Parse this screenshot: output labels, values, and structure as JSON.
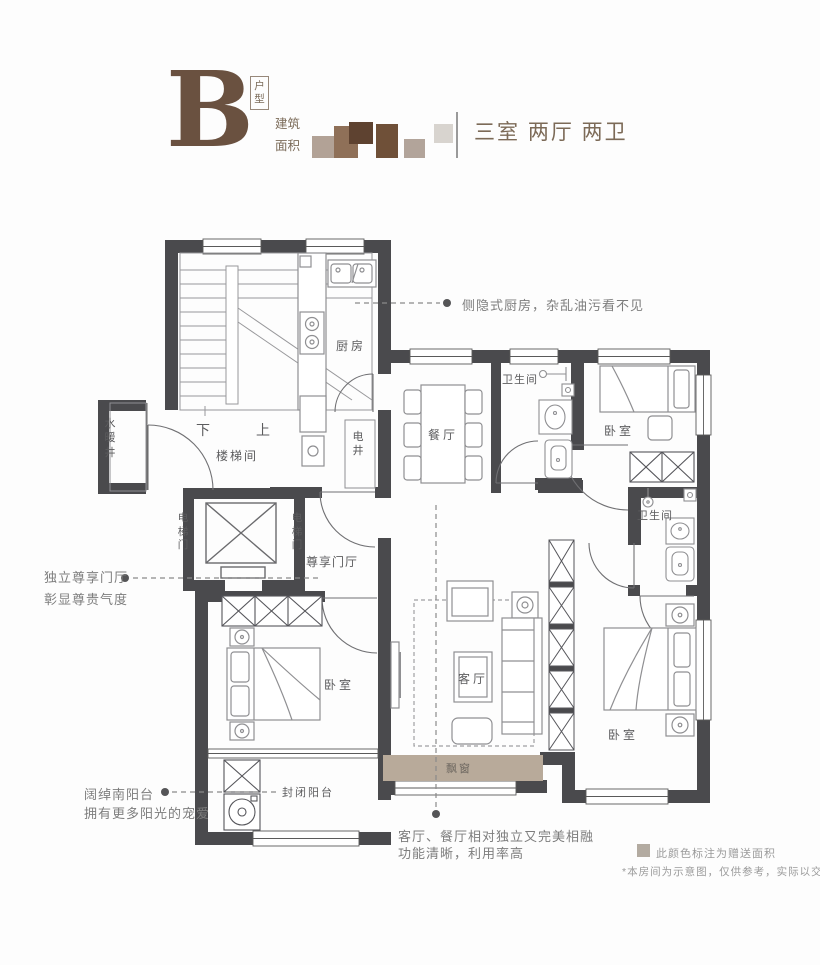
{
  "header": {
    "type_letter": "B",
    "type_badge": "户型",
    "area_label": "建筑面积",
    "layout_summary": "三室 两厅 两卫"
  },
  "rooms": {
    "kitchen": "厨房",
    "dining": "餐厅",
    "bath_top": "卫生间",
    "bath_right": "卫生间",
    "bedroom_top_right": "卧室",
    "bedroom_left": "卧室",
    "bedroom_bottom_right": "卧室",
    "water_shaft": "水暖井",
    "stairwell": "楼梯间",
    "electric_shaft": "电井",
    "elevator_door_left": "电梯门",
    "elevator_door_right": "电梯门",
    "foyer": "尊享门厅",
    "living": "客厅",
    "balcony": "封闭阳台",
    "bay_window": "飘窗",
    "stair_down": "下",
    "stair_up": "上"
  },
  "annotations": {
    "kitchen_note": "侧隐式厨房，杂乱油污看不见",
    "foyer_note_line1": "独立尊享门厅",
    "foyer_note_line2": "彰显尊贵气度",
    "balcony_note_line1": "阔绰南阳台",
    "balcony_note_line2": "拥有更多阳光的宠爱",
    "living_note_line1": "客厅、餐厅相对独立又完美相融",
    "living_note_line2": "功能清晰，利用率高"
  },
  "legend": {
    "gift_area": "此颜色标注为赠送面积",
    "disclaimer": "*本房间为示意图，仅供参考，实际以交付为准"
  },
  "colors": {
    "wall": "#4a4a4d",
    "gift_area_fill": "#b8aa9a",
    "brand_brown": "#6a5140",
    "annotation_gray": "#7d7d7d"
  }
}
